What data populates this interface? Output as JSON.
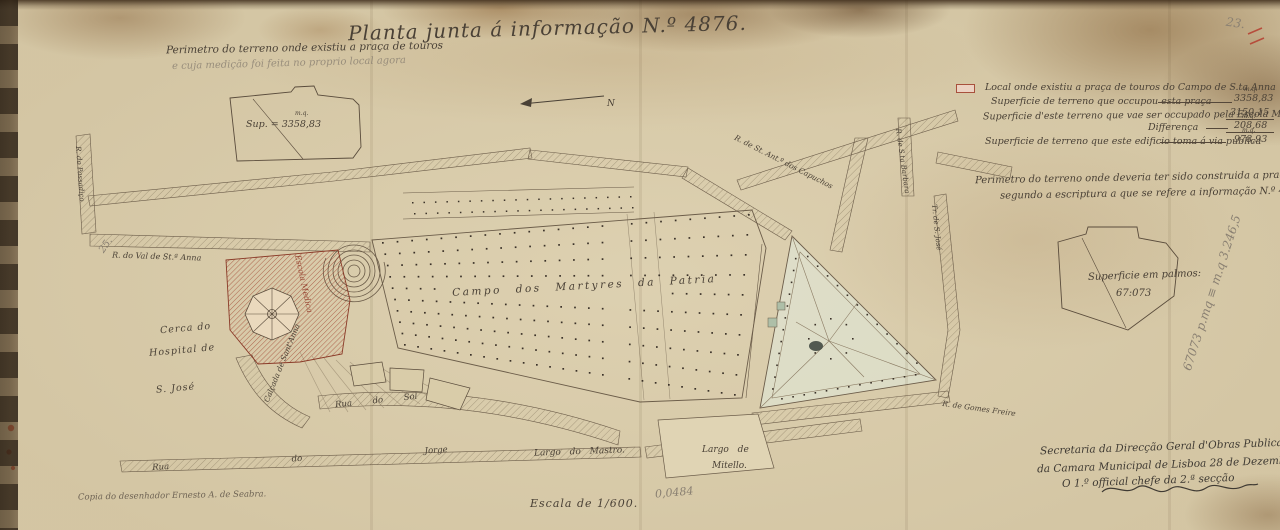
{
  "page": {
    "title": "Planta junta á informação N.º 4876.",
    "scale_note": "Escala de 1/600.",
    "pencil_scale": "0,0484",
    "corner_pencil": "23.",
    "left_pencil": "25.",
    "copy_note": "Copia do desenhador Ernesto A. de Seabra.",
    "north_label": "N"
  },
  "perimeter_existing": {
    "heading": "Perimetro do terreno onde existiu a praça de touros",
    "pencil_note": "e cuja medição foi feita no proprio local agora",
    "area_label": "Sup. = 3358,83",
    "area_unit": "m.q."
  },
  "legend": {
    "line1": "Local onde existiu a praça de touros do Campo de S.ta Anna",
    "line2_label": "Superficie de terreno que occupou esta praça",
    "line2_value": "3358,83",
    "line3_label": "Superficie d'este terreno que vae ser occupado pela Escola Medica.",
    "line3_value": "3150,15",
    "line4_label": "Differença",
    "line4_value": "208,68",
    "line5_label": "Superficie de terreno que este edificio toma á via publica",
    "line5_value": "978,93",
    "unit": "m.q."
  },
  "perimeter_planned": {
    "line1": "Perimetro do terreno onde deveria ter sido construida a praça de touros,",
    "line2": "segundo a escriptura a que se refere a informação N.º 4870",
    "area_label": "Superficie em palmos:",
    "area_value": "67:073",
    "pencil_conversion": "67073 p.mq ≡ m.q 3.246,5"
  },
  "map_labels": {
    "campo": "Campo dos Martyres da Patria",
    "cerca_line1": "Cerca do",
    "cerca_line2": "Hospital de",
    "cerca_line3": "S. José",
    "rua_sol": "Rua do Sol",
    "rua_jorge": "Rua do Jorge",
    "largo_mastro": "Largo do Mastro.",
    "largo_mitello_line1": "Largo de",
    "largo_mitello_line2": "Mitello.",
    "capuchos": "R. de St. Ant.º dos Capuchos",
    "santa_barbara": "R. de S.ta Barbara",
    "tr_sao_jose": "Tr. de S. José",
    "gomes_freire": "R. de Gomes Freire",
    "calcada_santanna": "Calçada de Sant'Anna",
    "val_santanna": "R. do Val de St.ª Anna",
    "passadico": "R. do Passadiço",
    "escola_medica": "Escola Medica"
  },
  "signature_block": {
    "line1": "Secretaria da Direcção Geral d'Obras Publicas",
    "line2": "da Camara Municipal de Lisboa 28 de Dezembro de 1890.",
    "line3": "O 1.º official chefe da 2.ª secção"
  },
  "colors": {
    "parchment": "#d5c7a5",
    "ink": "#4a4136",
    "red_hatch": "#9e3a28",
    "pencil": "#8a8072",
    "stain_brown": "#8a6337",
    "garden_green": "#dfe8d8"
  }
}
